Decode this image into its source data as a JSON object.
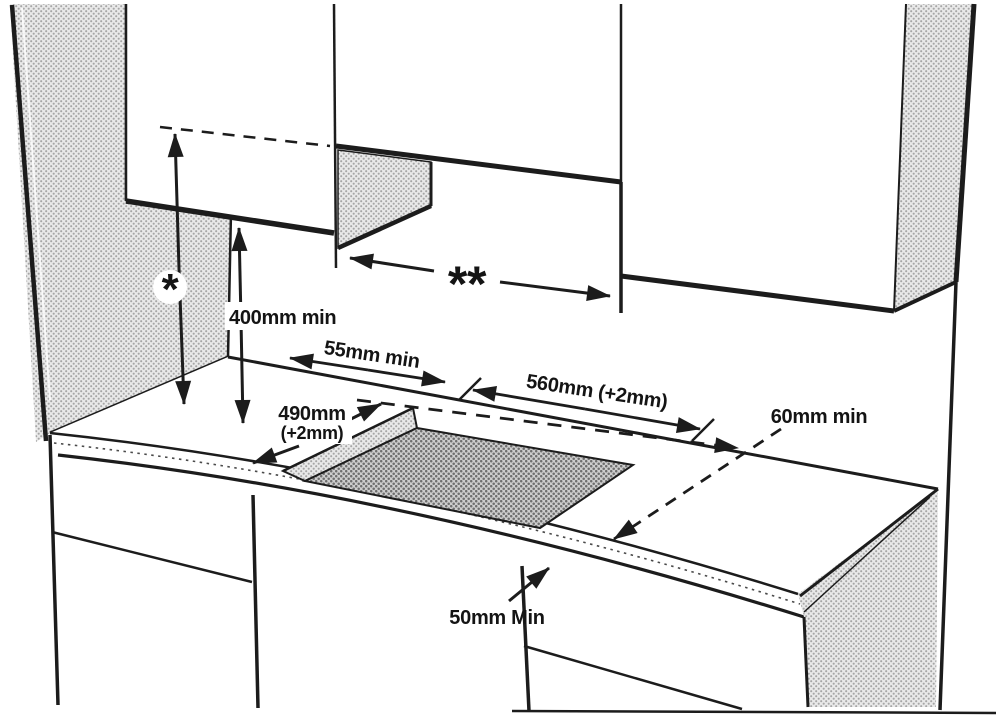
{
  "diagram": {
    "labels": {
      "hood_height_symbol": "*",
      "hood_width_symbol": "**",
      "clearance_above_worktop": "400mm min",
      "rear_clearance": "55mm min",
      "cutout_width": "560mm (+2mm)",
      "cutout_depth_line1": "490mm",
      "cutout_depth_line2": "(+2mm)",
      "right_clearance": "60mm min",
      "front_clearance": "50mm Min"
    },
    "colors": {
      "line": "#1c1c1c",
      "hatch_light": "#c9c9c9",
      "hatch_dark": "#9e9e9e",
      "background": "#ffffff"
    }
  }
}
